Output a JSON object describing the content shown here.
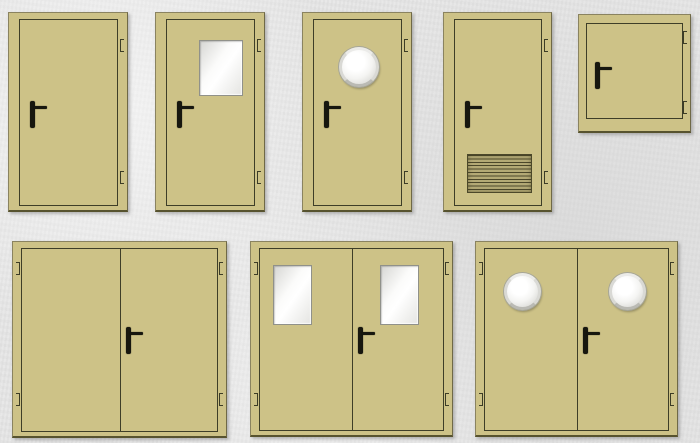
{
  "page": {
    "description": "Catalog sheet of beige metal doors shown on a gray concrete background",
    "background_color": "#e6e6e6"
  },
  "colors": {
    "door_fill": "#cdc287",
    "leaf_outline": "#3e3e28",
    "frame_edge": "#8a8360",
    "frame_shadow_edge": "#57532f",
    "hardware_black": "#17170f",
    "glass_highlight": "#ffffff",
    "glass_shade": "#d6d6d3",
    "window_frame_gray": "#90918a",
    "porthole_ring": "#d9d9d5",
    "louver_dark": "#4c482a",
    "louver_bg": "#b4aa75"
  },
  "rows": {
    "top": "five single-leaf doors and one hatch",
    "bottom": "three double-leaf doors"
  },
  "doors": [
    {
      "id": "single-plain",
      "leaves": 1,
      "window": "none",
      "vent": false,
      "handle_side": "left",
      "hinges": 2,
      "title": "Single-leaf solid door, lever handle left, two hinges right"
    },
    {
      "id": "single-glazed",
      "leaves": 1,
      "window": "rectangular",
      "vent": false,
      "handle_side": "left",
      "hinges": 2,
      "title": "Single-leaf door with rectangular glazed window"
    },
    {
      "id": "single-porthole",
      "leaves": 1,
      "window": "round",
      "vent": false,
      "handle_side": "left",
      "hinges": 2,
      "title": "Single-leaf door with round porthole window"
    },
    {
      "id": "single-vented",
      "leaves": 1,
      "window": "none",
      "vent": true,
      "handle_side": "left",
      "hinges": 2,
      "title": "Single-leaf door with ventilation louver grille at bottom"
    },
    {
      "id": "hatch",
      "leaves": 1,
      "window": "none",
      "vent": false,
      "handle_side": "left",
      "hinges": 2,
      "title": "Square technical hatch with lever handle"
    },
    {
      "id": "double-plain",
      "leaves": 2,
      "window": "none",
      "vent": false,
      "handle_side": "right-leaf",
      "hinges": 4,
      "title": "Double-leaf solid door, handle on right leaf"
    },
    {
      "id": "double-glazed",
      "leaves": 2,
      "window": "rectangular",
      "vent": false,
      "handle_side": "right-leaf",
      "hinges": 4,
      "title": "Double-leaf door with a rectangular window in each leaf"
    },
    {
      "id": "double-porthole",
      "leaves": 2,
      "window": "round",
      "vent": false,
      "handle_side": "right-leaf",
      "hinges": 4,
      "title": "Double-leaf door with a round porthole in each leaf"
    }
  ]
}
